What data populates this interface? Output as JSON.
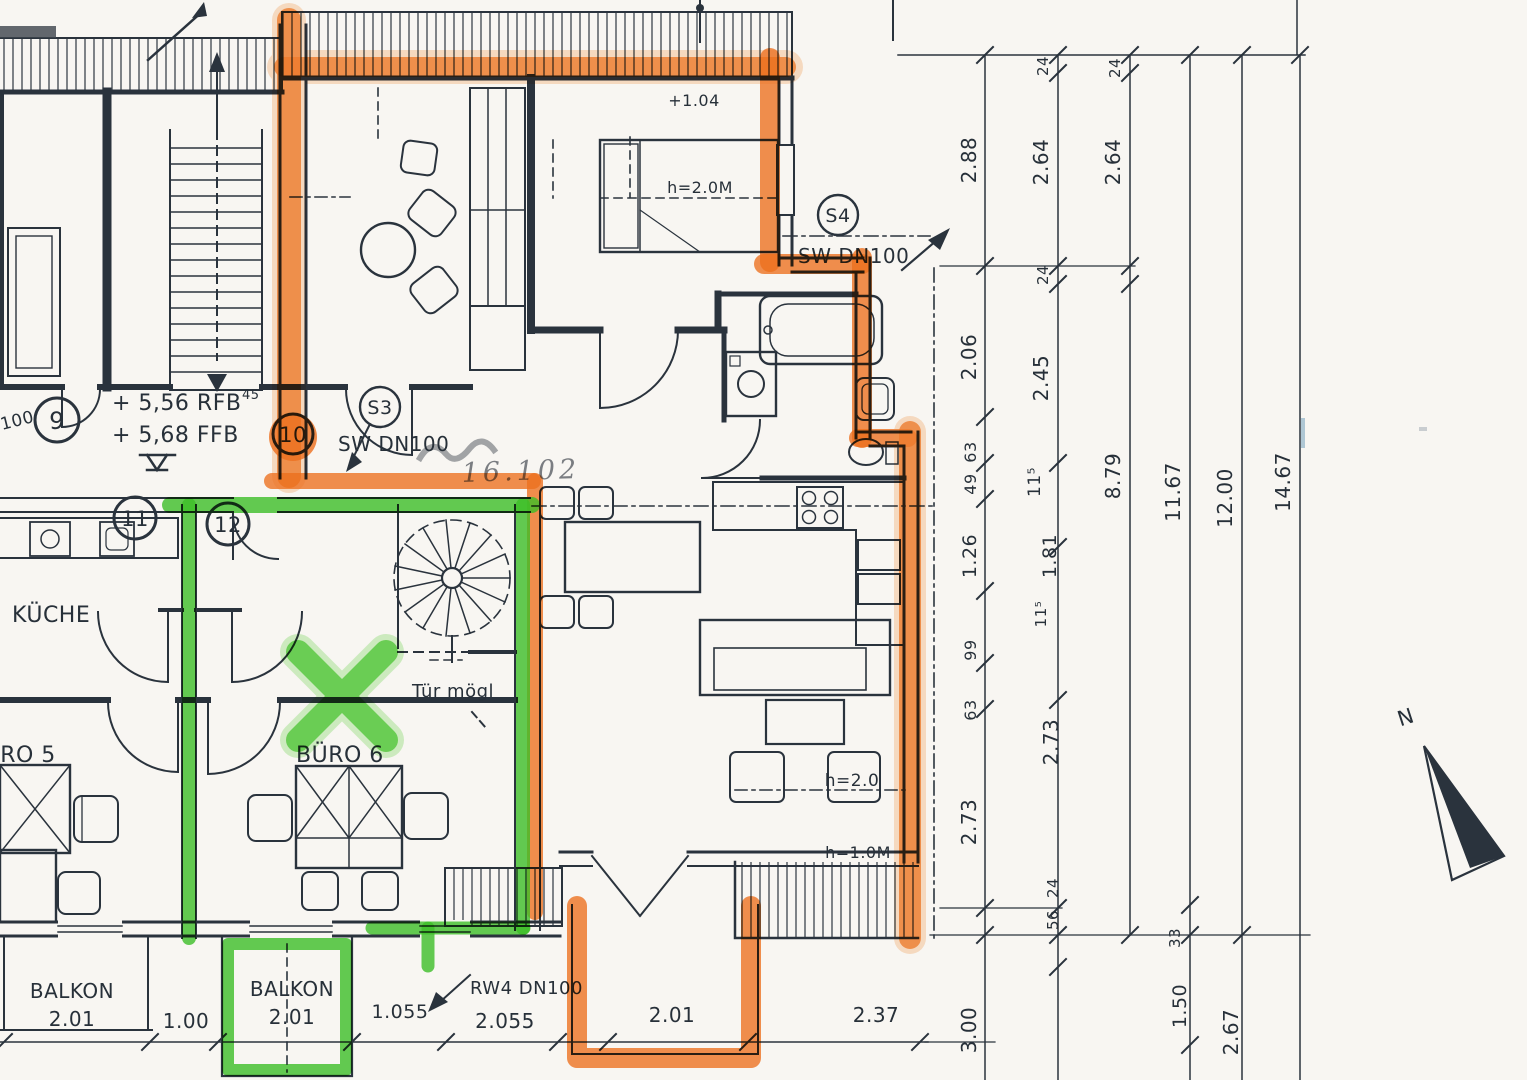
{
  "title": "Scanned attic floor plan (Dachgeschoss) with orange and green highlighter markup",
  "colors": {
    "paper": "#f8f6f2",
    "ink": "#2a333d",
    "orange_marker": "#f4731f",
    "green_marker": "#3fc629"
  },
  "plan": {
    "rooms": [
      "KÜCHE",
      "BÜRO 5",
      "BÜRO 6",
      "BALKON",
      "BALKON"
    ],
    "position_markers": [
      "9",
      "10",
      "11",
      "12"
    ],
    "pipe_markers": [
      {
        "id": "S3",
        "type": "SW DN100"
      },
      {
        "id": "S4",
        "type": "SW DN100"
      },
      {
        "id": "RW4",
        "type": "RW4 DN100"
      }
    ],
    "floor_levels": [
      "+ 5,56 RFB",
      "+ 5,68 FFB"
    ],
    "height_notes": [
      "+1.04",
      "h=2.0M",
      "h=2.0",
      "h=1.0M"
    ],
    "door_note": "Tür mögl",
    "north_label": "N",
    "balcony_sizes": [
      "2.01",
      "2.01",
      "2.01"
    ],
    "bottom_dimensions": [
      "1.00",
      "1.055",
      "2.055",
      "2.01",
      "2.37",
      "3.00"
    ],
    "right_dimension_chains": [
      [
        "2.88",
        "2.06",
        "63",
        "49",
        "1.26",
        "99",
        "63",
        "2.73",
        "3.00"
      ],
      [
        "24",
        "2.64",
        "24",
        "2.45",
        "11⁵",
        "1.81",
        "11⁵",
        "2.73",
        "24",
        "56"
      ],
      [
        "24",
        "2.64",
        "8.79"
      ],
      [
        "11.67",
        "33",
        "1.50"
      ],
      [
        "12.00",
        "2.67"
      ],
      [
        "14.67"
      ]
    ]
  },
  "labels": [
    {
      "id": "level-rfb",
      "text": "+ 5,56 RFB",
      "x": 112,
      "y": 410,
      "size": 22,
      "anchor": "start"
    },
    {
      "id": "level-ffb",
      "text": "+ 5,68 FFB",
      "x": 112,
      "y": 442,
      "size": 22,
      "anchor": "start"
    },
    {
      "id": "pos-9",
      "text": "9",
      "x": 57,
      "y": 429,
      "size": 24,
      "anchor": "middle"
    },
    {
      "id": "pos-10",
      "text": "10",
      "x": 293,
      "y": 442,
      "size": 21,
      "anchor": "middle"
    },
    {
      "id": "pos-11",
      "text": "11",
      "x": 135,
      "y": 526,
      "size": 21,
      "anchor": "middle"
    },
    {
      "id": "pos-12",
      "text": "12",
      "x": 228,
      "y": 532,
      "size": 21,
      "anchor": "middle"
    },
    {
      "id": "s3-id",
      "text": "S3",
      "x": 380,
      "y": 414,
      "size": 19,
      "anchor": "middle"
    },
    {
      "id": "s3-label",
      "text": "SW DN100",
      "x": 338,
      "y": 451,
      "size": 20,
      "anchor": "start"
    },
    {
      "id": "s4-id",
      "text": "S4",
      "x": 838,
      "y": 222,
      "size": 19,
      "anchor": "middle"
    },
    {
      "id": "s4-label",
      "text": "SW DN100",
      "x": 798,
      "y": 263,
      "size": 20,
      "anchor": "start"
    },
    {
      "id": "rw4-label",
      "text": "RW4 DN100",
      "x": 470,
      "y": 994,
      "size": 18,
      "anchor": "start"
    },
    {
      "id": "room-kueche",
      "text": "KÜCHE",
      "x": 12,
      "y": 622,
      "size": 22,
      "anchor": "start"
    },
    {
      "id": "room-buero5",
      "text": "BÜRO 5",
      "x": -32,
      "y": 762,
      "size": 22,
      "anchor": "start"
    },
    {
      "id": "room-buero6",
      "text": "BÜRO 6",
      "x": 296,
      "y": 762,
      "size": 22,
      "anchor": "start"
    },
    {
      "id": "balkon1-name",
      "text": "BALKON",
      "x": 72,
      "y": 998,
      "size": 20,
      "anchor": "middle"
    },
    {
      "id": "balkon1-size",
      "text": "2.01",
      "x": 72,
      "y": 1026,
      "size": 20,
      "anchor": "middle"
    },
    {
      "id": "balkon2-name",
      "text": "BALKON",
      "x": 292,
      "y": 996,
      "size": 20,
      "anchor": "middle"
    },
    {
      "id": "balkon2-size",
      "text": "2.01",
      "x": 292,
      "y": 1024,
      "size": 20,
      "anchor": "middle"
    },
    {
      "id": "dim-1-00",
      "text": "1.00",
      "x": 186,
      "y": 1028,
      "size": 20,
      "anchor": "middle"
    },
    {
      "id": "dim-1-055",
      "text": "1.055",
      "x": 400,
      "y": 1018,
      "size": 19,
      "anchor": "middle"
    },
    {
      "id": "dim-2-055",
      "text": "2.055",
      "x": 505,
      "y": 1028,
      "size": 20,
      "anchor": "middle"
    },
    {
      "id": "dim-2-01",
      "text": "2.01",
      "x": 672,
      "y": 1022,
      "size": 20,
      "anchor": "middle"
    },
    {
      "id": "dim-2-37",
      "text": "2.37",
      "x": 876,
      "y": 1022,
      "size": 20,
      "anchor": "middle"
    },
    {
      "id": "note-plus104",
      "text": "+1.04",
      "x": 694,
      "y": 106,
      "size": 16,
      "anchor": "middle"
    },
    {
      "id": "note-h20m",
      "text": "h=2.0M",
      "x": 700,
      "y": 193,
      "size": 16,
      "anchor": "middle"
    },
    {
      "id": "note-h20",
      "text": "h=2.0",
      "x": 852,
      "y": 786,
      "size": 17,
      "anchor": "middle"
    },
    {
      "id": "note-h10m",
      "text": "h=1.0M",
      "x": 858,
      "y": 858,
      "size": 16,
      "anchor": "middle"
    },
    {
      "id": "note-tuer-moegl",
      "text": "Tür mögl",
      "x": 412,
      "y": 697,
      "size": 18,
      "anchor": "start"
    },
    {
      "id": "note-45",
      "text": "45",
      "x": 242,
      "y": 399,
      "size": 13,
      "anchor": "start"
    },
    {
      "id": "partial-dn100",
      "text": "100",
      "x": 2,
      "y": 430,
      "size": 17,
      "anchor": "start",
      "rot": -14
    },
    {
      "id": "stamp-note",
      "text": "16.102",
      "x": 462,
      "y": 482,
      "size": 27,
      "anchor": "start",
      "rot": -2,
      "cls": "stamp"
    },
    {
      "id": "north-label",
      "text": "N",
      "x": 1408,
      "y": 724,
      "size": 21,
      "anchor": "middle",
      "rot": -18
    },
    {
      "id": "vdim-2-88",
      "text": "2.88",
      "x": 976,
      "y": 160,
      "size": 20,
      "rot": -90,
      "anchor": "middle"
    },
    {
      "id": "vdim-2-06",
      "text": "2.06",
      "x": 976,
      "y": 357,
      "size": 20,
      "rot": -90,
      "anchor": "middle"
    },
    {
      "id": "vdim-63a",
      "text": "63",
      "x": 976,
      "y": 452,
      "size": 16,
      "rot": -90,
      "anchor": "middle"
    },
    {
      "id": "vdim-49",
      "text": "49",
      "x": 976,
      "y": 484,
      "size": 16,
      "rot": -90,
      "anchor": "middle"
    },
    {
      "id": "vdim-1-26",
      "text": "1.26",
      "x": 976,
      "y": 556,
      "size": 19,
      "rot": -90,
      "anchor": "middle"
    },
    {
      "id": "vdim-99",
      "text": "99",
      "x": 976,
      "y": 650,
      "size": 16,
      "rot": -90,
      "anchor": "middle"
    },
    {
      "id": "vdim-63b",
      "text": "63",
      "x": 976,
      "y": 710,
      "size": 16,
      "rot": -90,
      "anchor": "middle"
    },
    {
      "id": "vdim-2-73a",
      "text": "2.73",
      "x": 976,
      "y": 822,
      "size": 20,
      "rot": -90,
      "anchor": "middle"
    },
    {
      "id": "vdim-3-00",
      "text": "3.00",
      "x": 976,
      "y": 1030,
      "size": 20,
      "rot": -90,
      "anchor": "middle"
    },
    {
      "id": "vdim-24a",
      "text": "24",
      "x": 1048,
      "y": 66,
      "size": 15,
      "rot": -90,
      "anchor": "middle"
    },
    {
      "id": "vdim-2-64a",
      "text": "2.64",
      "x": 1048,
      "y": 162,
      "size": 20,
      "rot": -90,
      "anchor": "middle"
    },
    {
      "id": "vdim-24b",
      "text": "24",
      "x": 1048,
      "y": 275,
      "size": 15,
      "rot": -90,
      "anchor": "middle"
    },
    {
      "id": "vdim-2-45",
      "text": "2.45",
      "x": 1048,
      "y": 378,
      "size": 20,
      "rot": -90,
      "anchor": "middle"
    },
    {
      "id": "vdim-115a",
      "text": "11⁵",
      "x": 1040,
      "y": 482,
      "size": 17,
      "rot": -90,
      "anchor": "middle"
    },
    {
      "id": "vdim-1-81",
      "text": "1.81",
      "x": 1056,
      "y": 556,
      "size": 19,
      "rot": -90,
      "anchor": "middle"
    },
    {
      "id": "vdim-115b",
      "text": "11⁵",
      "x": 1046,
      "y": 614,
      "size": 15,
      "rot": -90,
      "anchor": "middle"
    },
    {
      "id": "vdim-2-73b",
      "text": "2.73",
      "x": 1058,
      "y": 742,
      "size": 20,
      "rot": -90,
      "anchor": "middle"
    },
    {
      "id": "vdim-24c",
      "text": "24",
      "x": 1058,
      "y": 888,
      "size": 15,
      "rot": -90,
      "anchor": "middle"
    },
    {
      "id": "vdim-56",
      "text": "56",
      "x": 1058,
      "y": 920,
      "size": 15,
      "rot": -90,
      "anchor": "middle"
    },
    {
      "id": "vdim-24d",
      "text": "24",
      "x": 1120,
      "y": 68,
      "size": 15,
      "rot": -90,
      "anchor": "middle"
    },
    {
      "id": "vdim-2-64b",
      "text": "2.64",
      "x": 1120,
      "y": 162,
      "size": 20,
      "rot": -90,
      "anchor": "middle"
    },
    {
      "id": "vdim-8-79",
      "text": "8.79",
      "x": 1120,
      "y": 476,
      "size": 20,
      "rot": -90,
      "anchor": "middle"
    },
    {
      "id": "vdim-11-67",
      "text": "11.67",
      "x": 1180,
      "y": 492,
      "size": 20,
      "rot": -90,
      "anchor": "middle"
    },
    {
      "id": "vdim-33",
      "text": "33",
      "x": 1180,
      "y": 938,
      "size": 15,
      "rot": -90,
      "anchor": "middle"
    },
    {
      "id": "vdim-1-50",
      "text": "1.50",
      "x": 1186,
      "y": 1006,
      "size": 19,
      "rot": -90,
      "anchor": "middle"
    },
    {
      "id": "vdim-12-00",
      "text": "12.00",
      "x": 1232,
      "y": 498,
      "size": 20,
      "rot": -90,
      "anchor": "middle"
    },
    {
      "id": "vdim-2-67",
      "text": "2.67",
      "x": 1238,
      "y": 1032,
      "size": 20,
      "rot": -90,
      "anchor": "middle"
    },
    {
      "id": "vdim-14-67",
      "text": "14.67",
      "x": 1290,
      "y": 482,
      "size": 20,
      "rot": -90,
      "anchor": "middle"
    }
  ]
}
